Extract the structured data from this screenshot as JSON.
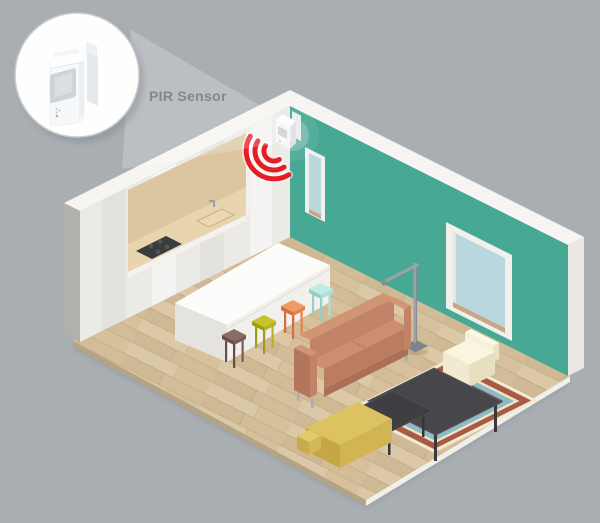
{
  "callout": {
    "label": "PIR Sensor",
    "icon": "pir-motion-sensor-device"
  },
  "sensor": {
    "icon": "wifi-signal-arcs",
    "wave_count": 3
  },
  "scene": {
    "items": [
      "pir-sensor-callout",
      "wall-mounted-pir-sensor",
      "signal-waves",
      "kitchen-cabinet-wall",
      "cooktop",
      "sink",
      "dining-table",
      "stool-brown",
      "stool-lime",
      "stool-orange",
      "stool-mint",
      "floor-lamp",
      "sofa",
      "armchair",
      "coffee-table-large",
      "coffee-table-small",
      "striped-rug",
      "yellow-chaise",
      "narrow-window",
      "large-window",
      "wood-floor"
    ]
  },
  "colors": {
    "background": "#a9aeb3",
    "wall_teal": "#47a893",
    "wall_white": "#eceae6",
    "wall_top": "#f6f5f1",
    "floor_wood": "#d8c5a2",
    "signal_red": "#e51e25",
    "sensor_white": "#f5f6f8",
    "label_text": "#83888d",
    "callout_border": "#c9cbcd",
    "sofa_terracotta": "#c28468",
    "armchair_cream": "#f4eed8",
    "chaise_yellow": "#ddc262",
    "table_white": "#fcfcfb",
    "coffee_table_dark": "#47474b",
    "stool_brown": "#7b5b57",
    "stool_lime": "#b9b81f",
    "stool_orange": "#e98450",
    "stool_mint": "#a6ded5",
    "rug_outer": "#f1ead2",
    "rug_red": "#a85a45",
    "rug_cream": "#ece4cb",
    "rug_blue": "#8fbac3",
    "rug_brown": "#6e4c3f",
    "rug_gold": "#c9aa52",
    "rug_center": "#d9c69d",
    "window_glass": "#b9d8dd",
    "window_trim": "#c8a685",
    "lamp_gray": "#9ba1a7",
    "niche_tan": "#dcc6a0"
  }
}
